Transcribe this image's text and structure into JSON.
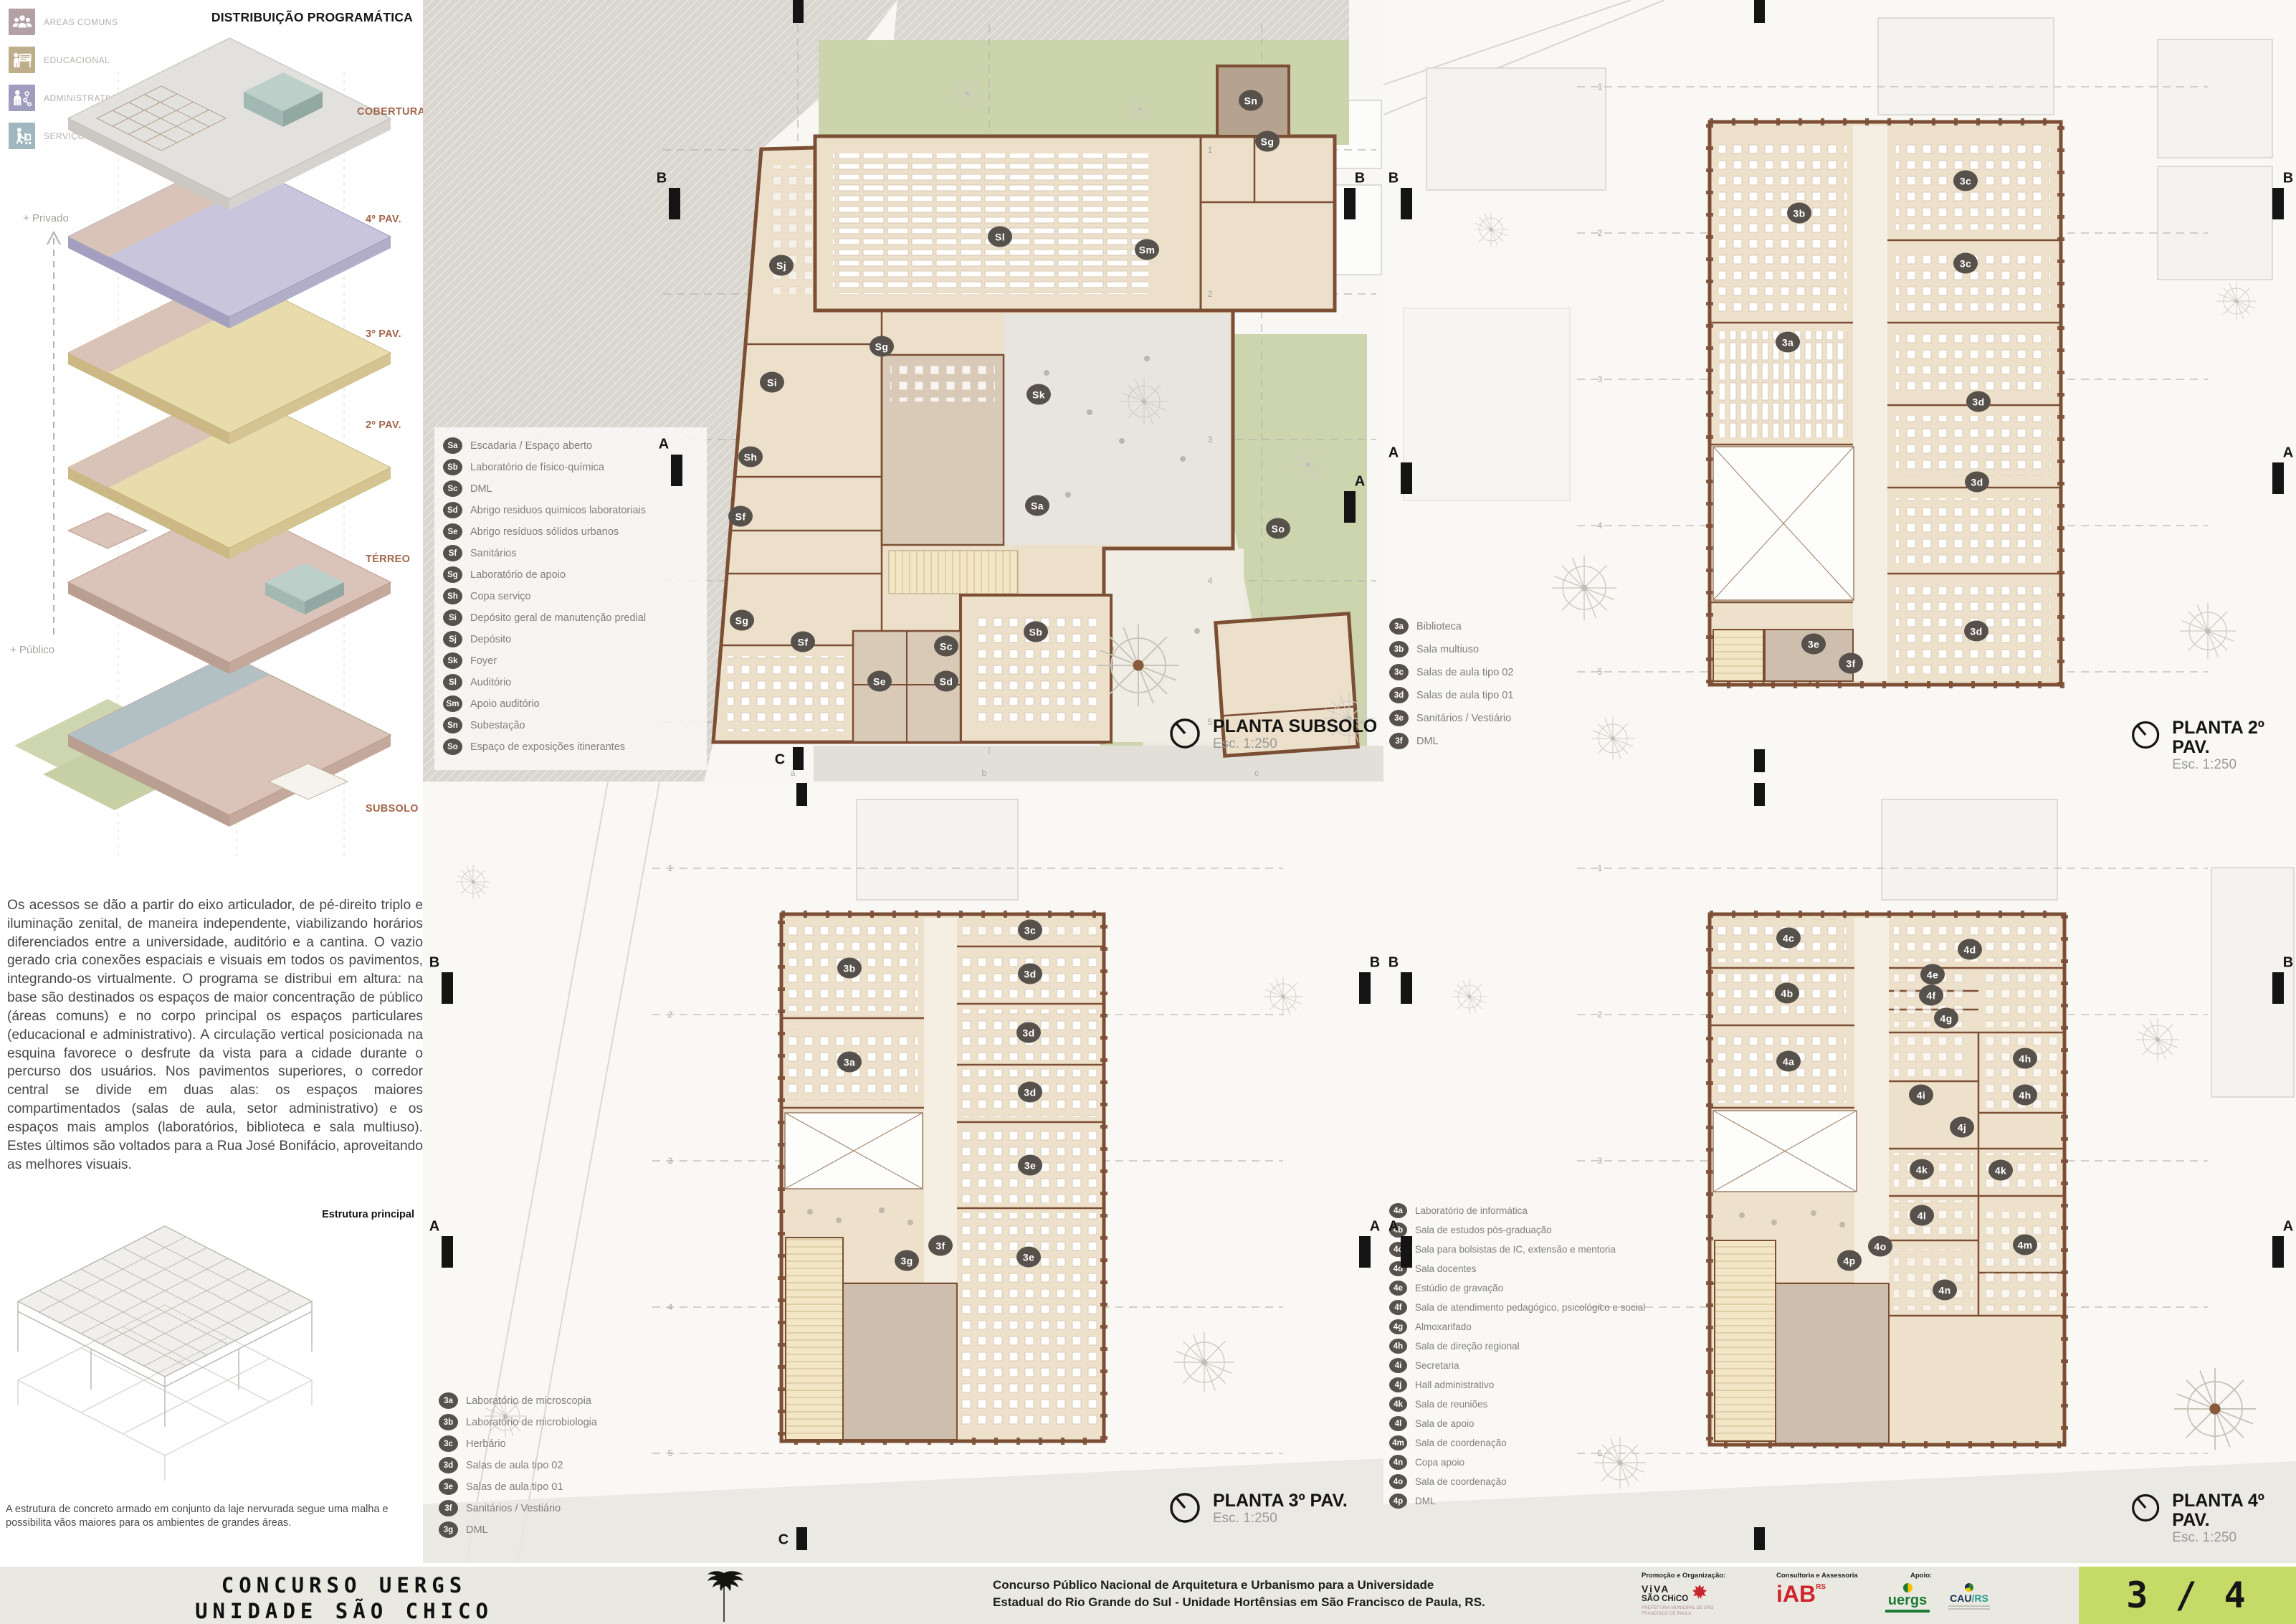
{
  "program": {
    "title": "DISTRIBUIÇÃO PROGRAMÁTICA",
    "categories": [
      {
        "label": "ÁREAS COMUNS",
        "color": "#b2a0a4",
        "icon": "common-areas-people-icon"
      },
      {
        "label": "EDUCACIONAL",
        "color": "#bfae8b",
        "icon": "educational-teacher-icon"
      },
      {
        "label": "ADMINISTRATIVO",
        "color": "#9f9cbe",
        "icon": "administrative-orgchart-icon"
      },
      {
        "label": "SERVIÇO",
        "color": "#a0b7bf",
        "icon": "service-cart-icon"
      }
    ],
    "floors": [
      "COBERTURA",
      "4º PAV.",
      "3º PAV.",
      "2º PAV.",
      "TÉRREO",
      "SUBSOLO"
    ],
    "gradient_top": "+ Privado",
    "gradient_bottom": "+ Público"
  },
  "description": "Os acessos se dão a partir do eixo articulador, de pé-direito triplo e iluminação zenital, de maneira independente, viabilizando horários diferenciados entre a universidade, auditório e a cantina. O vazio gerado cria conexões espaciais e visuais em todos os pavimentos, integrando-os virtualmente. O programa se distribui em altura: na base são destinados os espaços de maior concentração de público (áreas comuns) e no corpo principal os espaços particulares (educacional e administrativo). A circulação vertical posicionada na esquina favorece o desfrute da vista para a cidade durante o percurso dos usuários. Nos pavimentos superiores, o corredor central se divide em duas alas: os espaços maiores compartimentados (salas de aula, setor administrativo) e os espaços mais amplos (laboratórios, biblioteca e sala multiuso). Estes últimos são voltados para a Rua José Bonifácio, aproveitando as melhores visuais.",
  "structure": {
    "label": "Estrutura principal",
    "caption": "A estrutura de concreto armado em conjunto da laje nervurada segue uma malha e possibilita vãos maiores para os ambientes de grandes áreas."
  },
  "section_marks": {
    "a": "A",
    "b": "B",
    "c": "C"
  },
  "grid": {
    "rows": [
      "1",
      "2",
      "3",
      "4",
      "5"
    ],
    "cols": [
      "a",
      "b",
      "c"
    ]
  },
  "palette": {
    "wall": "#7c4f35",
    "room": "#ece0cb",
    "garden": "#ccd5ae",
    "badge": "#57514b"
  },
  "plans": {
    "subsolo": {
      "title": "PLANTA SUBSOLO",
      "scale": "Esc. 1:250",
      "legend": [
        {
          "code": "Sa",
          "label": "Escadaria / Espaço aberto"
        },
        {
          "code": "Sb",
          "label": "Laboratório de físico-química"
        },
        {
          "code": "Sc",
          "label": "DML"
        },
        {
          "code": "Sd",
          "label": "Abrigo residuos quimicos laboratoriais"
        },
        {
          "code": "Se",
          "label": "Abrigo resíduos sólidos urbanos"
        },
        {
          "code": "Sf",
          "label": "Sanitários"
        },
        {
          "code": "Sg",
          "label": "Laboratório de apoio"
        },
        {
          "code": "Sh",
          "label": "Copa serviço"
        },
        {
          "code": "Si",
          "label": "Depósito geral de manutenção predial"
        },
        {
          "code": "Sj",
          "label": "Depósito"
        },
        {
          "code": "Sk",
          "label": "Foyer"
        },
        {
          "code": "Sl",
          "label": "Auditório"
        },
        {
          "code": "Sm",
          "label": "Apoio auditório"
        },
        {
          "code": "Sn",
          "label": "Subestação"
        },
        {
          "code": "So",
          "label": "Espaço de exposições itinerantes"
        }
      ],
      "badges": [
        "Sn",
        "Sg",
        "Sl",
        "Sm",
        "Sj",
        "Sg",
        "Si",
        "Sk",
        "Sh",
        "Sf",
        "Sa",
        "So",
        "Sg",
        "Sf",
        "Se",
        "Sc",
        "Sd",
        "Sb"
      ]
    },
    "pav2": {
      "title": "PLANTA 2º PAV.",
      "scale": "Esc. 1:250",
      "legend": [
        {
          "code": "3a",
          "label": "Biblioteca"
        },
        {
          "code": "3b",
          "label": "Sala multiuso"
        },
        {
          "code": "3c",
          "label": "Salas de aula tipo 02"
        },
        {
          "code": "3d",
          "label": "Salas de aula tipo 01"
        },
        {
          "code": "3e",
          "label": "Sanitários / Vestiário"
        },
        {
          "code": "3f",
          "label": "DML"
        }
      ],
      "badges": [
        "3b",
        "3c",
        "3c",
        "3a",
        "3d",
        "3d",
        "3d",
        "3e",
        "3f"
      ]
    },
    "pav3": {
      "title": "PLANTA 3º PAV.",
      "scale": "Esc. 1:250",
      "legend": [
        {
          "code": "3a",
          "label": "Laboratório de microscopia"
        },
        {
          "code": "3b",
          "label": "Laboratório de microbiologia"
        },
        {
          "code": "3c",
          "label": "Herbário"
        },
        {
          "code": "3d",
          "label": "Salas de aula tipo 02"
        },
        {
          "code": "3e",
          "label": "Salas de aula tipo 01"
        },
        {
          "code": "3f",
          "label": "Sanitários / Vestiário"
        },
        {
          "code": "3g",
          "label": "DML"
        }
      ],
      "badges": [
        "3b",
        "3c",
        "3d",
        "3a",
        "3d",
        "3d",
        "3e",
        "3f",
        "3g",
        "3e"
      ]
    },
    "pav4": {
      "title": "PLANTA 4º PAV.",
      "scale": "Esc. 1:250",
      "legend": [
        {
          "code": "4a",
          "label": "Laboratório de informática"
        },
        {
          "code": "4b",
          "label": "Sala de estudos pós-graduação"
        },
        {
          "code": "4c",
          "label": "Sala para bolsistas de IC, extensão e mentoria"
        },
        {
          "code": "4d",
          "label": "Sala docentes"
        },
        {
          "code": "4e",
          "label": "Estúdio de gravação"
        },
        {
          "code": "4f",
          "label": "Sala de atendimento pedagógico, psicológico e social"
        },
        {
          "code": "4g",
          "label": "Almoxarifado"
        },
        {
          "code": "4h",
          "label": "Sala de direção regional"
        },
        {
          "code": "4i",
          "label": "Secretaria"
        },
        {
          "code": "4j",
          "label": "Hall administrativo"
        },
        {
          "code": "4k",
          "label": "Sala de reuniões"
        },
        {
          "code": "4l",
          "label": "Sala de apoio"
        },
        {
          "code": "4m",
          "label": "Sala de coordenação"
        },
        {
          "code": "4n",
          "label": "Copa apoio"
        },
        {
          "code": "4o",
          "label": "Sala de coordenação"
        },
        {
          "code": "4p",
          "label": "DML"
        }
      ],
      "badges": [
        "4c",
        "4b",
        "4a",
        "4d",
        "4e",
        "4f",
        "4g",
        "4h",
        "4i",
        "4h",
        "4j",
        "4k",
        "4k",
        "4l",
        "4o",
        "4p",
        "4m",
        "4n"
      ]
    }
  },
  "footer": {
    "competition_line1": "CONCURSO  UERGS",
    "competition_line2": "UNIDADE  SÃO CHICO",
    "description_line1": "Concurso Público Nacional de Arquitetura e Urbanismo para a Universidade",
    "description_line2": "Estadual do Rio Grande do Sul - Unidade Hortênsias em São Francisco de Paula, RS.",
    "credits": {
      "org_heading": "Promoção e Organização:",
      "org_logo_line1": "ViVA",
      "org_logo_line2": "SÃO CHiCO",
      "org_sub": "PREFEITURA MUNICIPAL DE SÃO FRANCISCO DE PAULA",
      "consult_heading": "Consultoria e Assessoria",
      "consult_logo": "iAB",
      "consult_logo_sup": "RS",
      "support_heading": "Apoio:",
      "support_logo1": "uergs",
      "support_logo2_a": "CAU",
      "support_logo2_b": "/RS"
    },
    "page_number": "3 / 4",
    "page_accent": "#c6da68"
  }
}
